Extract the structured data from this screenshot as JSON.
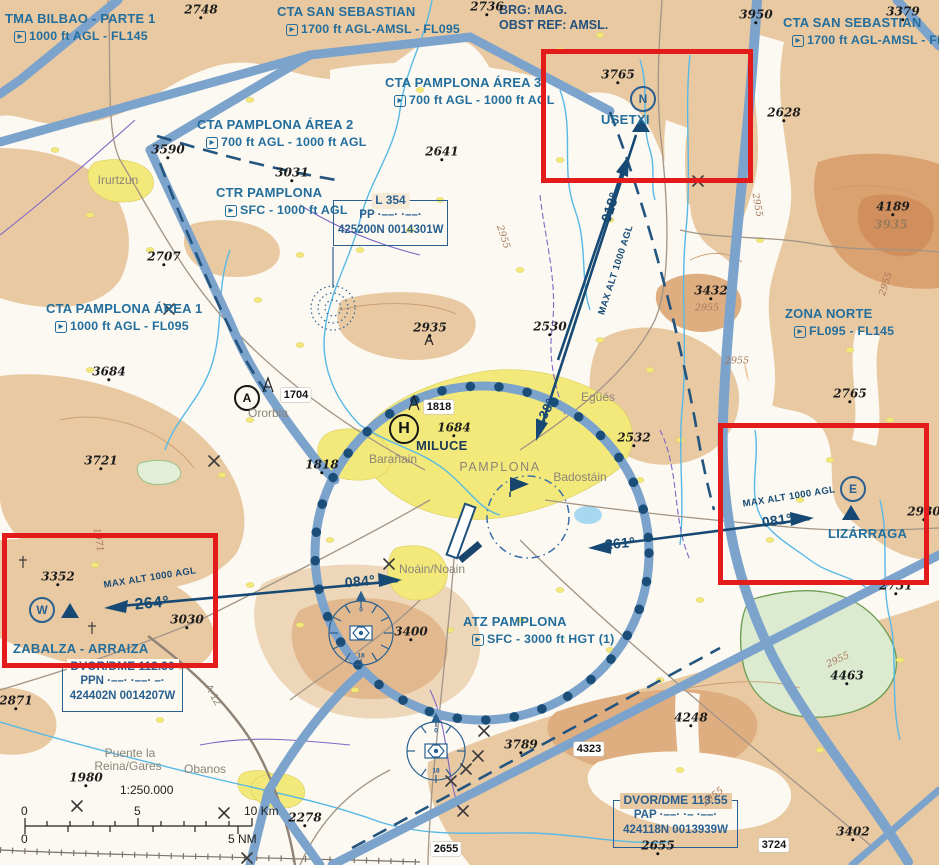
{
  "header": {
    "brg": "BRG: MAG.",
    "obst": "OBST REF: AMSL."
  },
  "airspace_labels": [
    {
      "id": "tma-bilbao-parte-1",
      "name": "TMA BILBAO - PARTE 1",
      "limits": "1000 ft AGL - FL145",
      "x": 5,
      "y": 10
    },
    {
      "id": "cta-san-sebastian-west",
      "name": "CTA SAN SEBASTIAN",
      "limits": "1700 ft AGL-AMSL - FL095",
      "x": 277,
      "y": 3
    },
    {
      "id": "cta-pamplona-area-3",
      "name": "CTA PAMPLONA ÁREA 3",
      "limits": "700 ft AGL - 1000 ft AGL",
      "x": 385,
      "y": 74
    },
    {
      "id": "cta-pamplona-area-2",
      "name": "CTA PAMPLONA ÁREA 2",
      "limits": "700 ft AGL - 1000 ft AGL",
      "x": 197,
      "y": 116
    },
    {
      "id": "ctr-pamplona",
      "name": "CTR PAMPLONA",
      "limits": "SFC - 1000 ft AGL",
      "x": 216,
      "y": 184
    },
    {
      "id": "cta-pamplona-area-1",
      "name": "CTA PAMPLONA ÁREA 1",
      "limits": "1000 ft AGL - FL095",
      "x": 46,
      "y": 300
    },
    {
      "id": "cta-san-sebastian-east",
      "name": "CTA SAN SEBASTIAN",
      "limits": "1700 ft AGL-AMSL - FL095",
      "x": 783,
      "y": 14
    },
    {
      "id": "zona-norte",
      "name": "ZONA NORTE",
      "limits": "FL095 - FL145",
      "x": 785,
      "y": 305
    },
    {
      "id": "atz-pamplona",
      "name": "ATZ PAMPLONA",
      "limits": "SFC - 3000 ft HGT (1)",
      "x": 463,
      "y": 613
    }
  ],
  "nav_boxes": [
    {
      "id": "l-354",
      "title": "L 354",
      "ident": "PP",
      "morse": "·––· ·––·",
      "coords": "425200N 0014301W",
      "x": 333,
      "y": 200,
      "w": 113,
      "h": 44,
      "titlebg": "#f6ead6"
    },
    {
      "id": "dvor-dme-ppn",
      "title": "DVOR/DME 112.30",
      "ident": "PPN",
      "morse": "·––· ·––· –·",
      "coords": "424402N 0014207W",
      "x": 62,
      "y": 666,
      "w": 119,
      "h": 44,
      "titlebg": "#fbf9f1"
    },
    {
      "id": "dvor-dme-pap",
      "title": "DVOR/DME 113.55",
      "ident": "PAP",
      "morse": "·––· ·– ·––·",
      "coords": "424118N 0013939W",
      "x": 613,
      "y": 800,
      "w": 123,
      "h": 46,
      "titlebg": "#e9c9a2"
    }
  ],
  "vrps": [
    {
      "letter": "N",
      "name": "USETXI",
      "circle_cx": 643,
      "circle_cy": 99,
      "tri_cx": 641,
      "tri_cy": 132,
      "label_x": 601,
      "label_y": 112
    },
    {
      "letter": "E",
      "name": "LIZÁRRAGA",
      "circle_cx": 853,
      "circle_cy": 489,
      "tri_cx": 851,
      "tri_cy": 520,
      "label_x": 828,
      "label_y": 526
    },
    {
      "letter": "W",
      "name": "ZABALZA - ARRAIZA",
      "circle_cx": 42,
      "circle_cy": 610,
      "tri_cx": 70,
      "tri_cy": 618,
      "label_x": 13,
      "label_y": 641
    }
  ],
  "poi_circles": [
    {
      "letter": "A",
      "cx": 247,
      "cy": 398,
      "size": 22
    },
    {
      "letter": "H",
      "cx": 404,
      "cy": 429,
      "size": 26
    }
  ],
  "poi_labels": [
    {
      "text": "MILUCE",
      "x": 416,
      "y": 438,
      "size": 13,
      "color": "#1d3a57"
    }
  ],
  "bearings": [
    {
      "text": "018°",
      "cx": 610,
      "cy": 207,
      "rot": -72,
      "size": 14
    },
    {
      "text": "MAX ALT 1000 AGL",
      "cx": 616,
      "cy": 270,
      "rot": -72,
      "size": 9.5
    },
    {
      "text": "138°",
      "cx": 545,
      "cy": 412,
      "rot": -63,
      "size": 13
    },
    {
      "text": "261°",
      "cx": 620,
      "cy": 543,
      "rot": -5,
      "size": 14
    },
    {
      "text": "084°",
      "cx": 360,
      "cy": 581,
      "rot": -5,
      "size": 14
    },
    {
      "text": "264°",
      "cx": 152,
      "cy": 604,
      "rot": -5,
      "size": 16
    },
    {
      "text": "081°",
      "cx": 777,
      "cy": 520,
      "rot": -8,
      "size": 14
    },
    {
      "text": "MAX ALT 1000 AGL",
      "cx": 789,
      "cy": 497,
      "rot": -9,
      "size": 9.5
    },
    {
      "text": "MAX ALT 1000 AGL",
      "cx": 150,
      "cy": 578,
      "rot": -9,
      "size": 9.5
    }
  ],
  "spot_elevations": [
    {
      "v": "2748",
      "cx": 201,
      "cy": 10
    },
    {
      "v": "2736",
      "cx": 487,
      "cy": 7
    },
    {
      "v": "3950",
      "cx": 756,
      "cy": 15
    },
    {
      "v": "3379",
      "cx": 903,
      "cy": 12
    },
    {
      "v": "3765",
      "cx": 618,
      "cy": 75
    },
    {
      "v": "2628",
      "cx": 784,
      "cy": 113
    },
    {
      "v": "3590",
      "cx": 168,
      "cy": 150
    },
    {
      "v": "3031",
      "cx": 292,
      "cy": 173
    },
    {
      "v": "2641",
      "cx": 442,
      "cy": 152
    },
    {
      "v": "2707",
      "cx": 164,
      "cy": 257
    },
    {
      "v": "3684",
      "cx": 109,
      "cy": 372
    },
    {
      "v": "3721",
      "cx": 101,
      "cy": 461
    },
    {
      "v": "2935",
      "cx": 430,
      "cy": 328
    },
    {
      "v": "2530",
      "cx": 550,
      "cy": 327
    },
    {
      "v": "2532",
      "cx": 634,
      "cy": 438
    },
    {
      "v": "3432",
      "cx": 711,
      "cy": 291
    },
    {
      "v": "4189",
      "cx": 893,
      "cy": 207
    },
    {
      "v": "3935",
      "cx": 891,
      "cy": 225,
      "muted": true
    },
    {
      "v": "2765",
      "cx": 850,
      "cy": 394
    },
    {
      "v": "1684",
      "cx": 454,
      "cy": 428
    },
    {
      "v": "1818",
      "cx": 322,
      "cy": 465
    },
    {
      "v": "2930",
      "cx": 924,
      "cy": 512
    },
    {
      "v": "3352",
      "cx": 58,
      "cy": 577
    },
    {
      "v": "3030",
      "cx": 187,
      "cy": 620
    },
    {
      "v": "2871",
      "cx": 16,
      "cy": 701
    },
    {
      "v": "1980",
      "cx": 86,
      "cy": 778
    },
    {
      "v": "2278",
      "cx": 305,
      "cy": 818
    },
    {
      "v": "3400",
      "cx": 411,
      "cy": 632
    },
    {
      "v": "3789",
      "cx": 521,
      "cy": 745
    },
    {
      "v": "4248",
      "cx": 691,
      "cy": 718
    },
    {
      "v": "4463",
      "cx": 847,
      "cy": 676
    },
    {
      "v": "2655",
      "cx": 658,
      "cy": 846
    },
    {
      "v": "3402",
      "cx": 853,
      "cy": 832
    },
    {
      "v": "2731",
      "cx": 896,
      "cy": 586
    }
  ],
  "boxed_elevations": [
    {
      "v": "1704",
      "cx": 296,
      "cy": 395
    },
    {
      "v": "1818",
      "cx": 439,
      "cy": 407
    },
    {
      "v": "4323",
      "cx": 589,
      "cy": 749
    },
    {
      "v": "2655",
      "cx": 446,
      "cy": 849
    },
    {
      "v": "3724",
      "cx": 774,
      "cy": 845
    }
  ],
  "contour_labels": [
    {
      "v": "2955",
      "cx": 757,
      "cy": 205,
      "rot": 80
    },
    {
      "v": "2955",
      "cx": 886,
      "cy": 284,
      "rot": -72
    },
    {
      "v": "2955",
      "cx": 737,
      "cy": 361,
      "rot": 0
    },
    {
      "v": "2955",
      "cx": 503,
      "cy": 237,
      "rot": 72
    },
    {
      "v": "2955",
      "cx": 838,
      "cy": 660,
      "rot": -25
    },
    {
      "v": "2955",
      "cx": 713,
      "cy": 797,
      "rot": -38
    },
    {
      "v": "2955",
      "cx": 707,
      "cy": 308,
      "rot": 0
    },
    {
      "v": "1971",
      "cx": 98,
      "cy": 540,
      "rot": 80
    }
  ],
  "towns": [
    {
      "name": "Irurtzun",
      "cx": 118,
      "cy": 180
    },
    {
      "name": "Ororbia",
      "cx": 268,
      "cy": 413
    },
    {
      "name": "Barañain",
      "cx": 393,
      "cy": 459
    },
    {
      "name": "PAMPLONA",
      "cx": 500,
      "cy": 467,
      "size": 12.5,
      "spaced": true
    },
    {
      "name": "Badostáin",
      "cx": 580,
      "cy": 477
    },
    {
      "name": "Egüés",
      "cx": 598,
      "cy": 397
    },
    {
      "name": "Noáin/Noain",
      "cx": 432,
      "cy": 569
    },
    {
      "name": "Puente la",
      "cx": 130,
      "cy": 753
    },
    {
      "name": "Reina/Gares",
      "cx": 128,
      "cy": 766
    },
    {
      "name": "Obanos",
      "cx": 205,
      "cy": 769
    },
    {
      "name": "A-12",
      "cx": 213,
      "cy": 695,
      "rot": 62,
      "size": 10.5
    }
  ],
  "roses": [
    {
      "top": "0",
      "bottom": "18",
      "cx": 361,
      "cy": 633,
      "r": 32
    },
    {
      "top": "0",
      "bottom": "18",
      "cx": 436,
      "cy": 751,
      "r": 29
    }
  ],
  "scale": {
    "ratio": "1:250.000",
    "km0": "0",
    "km5": "5",
    "km10": "10 Km",
    "nm0": "0",
    "nm5": "5 NM"
  },
  "red_boxes": [
    {
      "id": "highlight-usetxi",
      "x": 541,
      "y": 49,
      "w": 202,
      "h": 124
    },
    {
      "id": "highlight-lizarraga",
      "x": 718,
      "y": 423,
      "w": 201,
      "h": 152
    },
    {
      "id": "highlight-zabalza",
      "x": 2,
      "y": 533,
      "w": 206,
      "h": 125
    }
  ],
  "colors": {
    "airspace_band": "#7ca3cc",
    "route_navy": "#164a74",
    "label_blue": "#236e9c",
    "highlight_red": "#e31b1b",
    "terrain_tan": "#e9c9a2",
    "town_yellow": "#f3e97b"
  }
}
